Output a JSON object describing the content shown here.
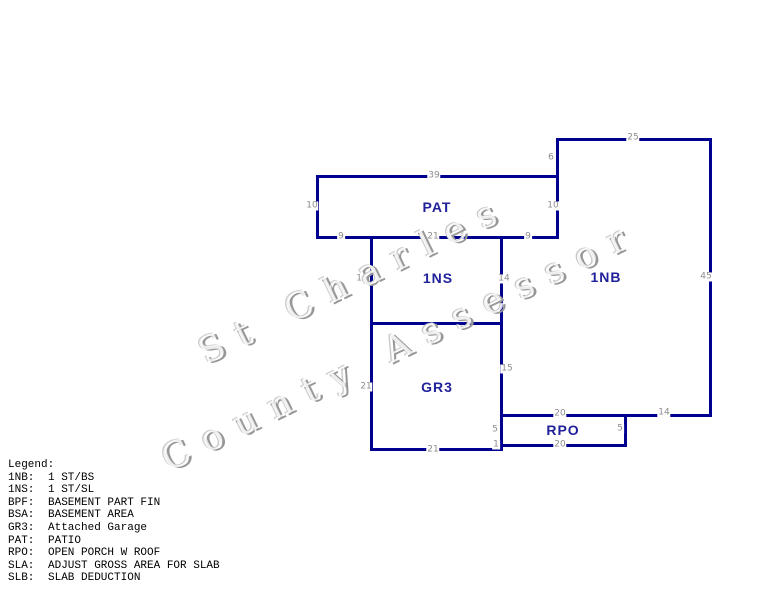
{
  "watermark": {
    "line1": "St Charles",
    "line2": "County Assessor",
    "shadow_color": "#979797",
    "highlight_color": "#c9c9c9"
  },
  "sketch": {
    "line_color": "#000090",
    "area_label_color": "#21219b",
    "dim_color": "#8c8c8c",
    "segments": [
      {
        "x1": 557,
        "y1": 139,
        "x2": 710,
        "y2": 139
      },
      {
        "x1": 317,
        "y1": 176,
        "x2": 557,
        "y2": 176
      },
      {
        "x1": 317,
        "y1": 237,
        "x2": 557,
        "y2": 237
      },
      {
        "x1": 371,
        "y1": 323,
        "x2": 501,
        "y2": 323
      },
      {
        "x1": 501,
        "y1": 415,
        "x2": 710,
        "y2": 415
      },
      {
        "x1": 501,
        "y1": 445,
        "x2": 625,
        "y2": 445
      },
      {
        "x1": 371,
        "y1": 449,
        "x2": 501,
        "y2": 449
      },
      {
        "x1": 317,
        "y1": 176,
        "x2": 317,
        "y2": 237
      },
      {
        "x1": 371,
        "y1": 237,
        "x2": 371,
        "y2": 449
      },
      {
        "x1": 501,
        "y1": 237,
        "x2": 501,
        "y2": 449
      },
      {
        "x1": 557,
        "y1": 139,
        "x2": 557,
        "y2": 237
      },
      {
        "x1": 710,
        "y1": 139,
        "x2": 710,
        "y2": 415
      },
      {
        "x1": 625,
        "y1": 415,
        "x2": 625,
        "y2": 445
      }
    ],
    "area_labels": [
      {
        "text": "PAT",
        "x": 437,
        "y": 207
      },
      {
        "text": "1NS",
        "x": 438,
        "y": 278
      },
      {
        "text": "1NB",
        "x": 606,
        "y": 277
      },
      {
        "text": "GR3",
        "x": 437,
        "y": 387
      },
      {
        "text": "RPO",
        "x": 563,
        "y": 430
      }
    ],
    "dimensions": [
      {
        "text": "25",
        "x": 633,
        "y": 138
      },
      {
        "text": "6",
        "x": 551,
        "y": 158
      },
      {
        "text": "39",
        "x": 434,
        "y": 176
      },
      {
        "text": "10",
        "x": 312,
        "y": 206
      },
      {
        "text": "10",
        "x": 553,
        "y": 206
      },
      {
        "text": "9",
        "x": 341,
        "y": 237
      },
      {
        "text": "21",
        "x": 433,
        "y": 237
      },
      {
        "text": "9",
        "x": 528,
        "y": 237
      },
      {
        "text": "14",
        "x": 362,
        "y": 279
      },
      {
        "text": "14",
        "x": 504,
        "y": 279
      },
      {
        "text": "45",
        "x": 706,
        "y": 277
      },
      {
        "text": "21",
        "x": 366,
        "y": 387
      },
      {
        "text": "15",
        "x": 507,
        "y": 369
      },
      {
        "text": "20",
        "x": 560,
        "y": 414
      },
      {
        "text": "14",
        "x": 664,
        "y": 413
      },
      {
        "text": "5",
        "x": 495,
        "y": 430
      },
      {
        "text": "5",
        "x": 620,
        "y": 429
      },
      {
        "text": "20",
        "x": 560,
        "y": 445
      },
      {
        "text": "1",
        "x": 496,
        "y": 445
      },
      {
        "text": "21",
        "x": 433,
        "y": 450
      }
    ]
  },
  "legend": {
    "title": "Legend:",
    "entries": [
      {
        "code": "1NB:",
        "desc": "1 ST/BS"
      },
      {
        "code": "1NS:",
        "desc": "1 ST/SL"
      },
      {
        "code": "BPF:",
        "desc": "BASEMENT PART FIN"
      },
      {
        "code": "BSA:",
        "desc": "BASEMENT AREA"
      },
      {
        "code": "GR3:",
        "desc": "Attached Garage"
      },
      {
        "code": "PAT:",
        "desc": "PATIO"
      },
      {
        "code": "RPO:",
        "desc": "OPEN PORCH W ROOF"
      },
      {
        "code": "SLA:",
        "desc": "ADJUST GROSS AREA FOR SLAB"
      },
      {
        "code": "SLB:",
        "desc": "SLAB DEDUCTION"
      }
    ]
  }
}
